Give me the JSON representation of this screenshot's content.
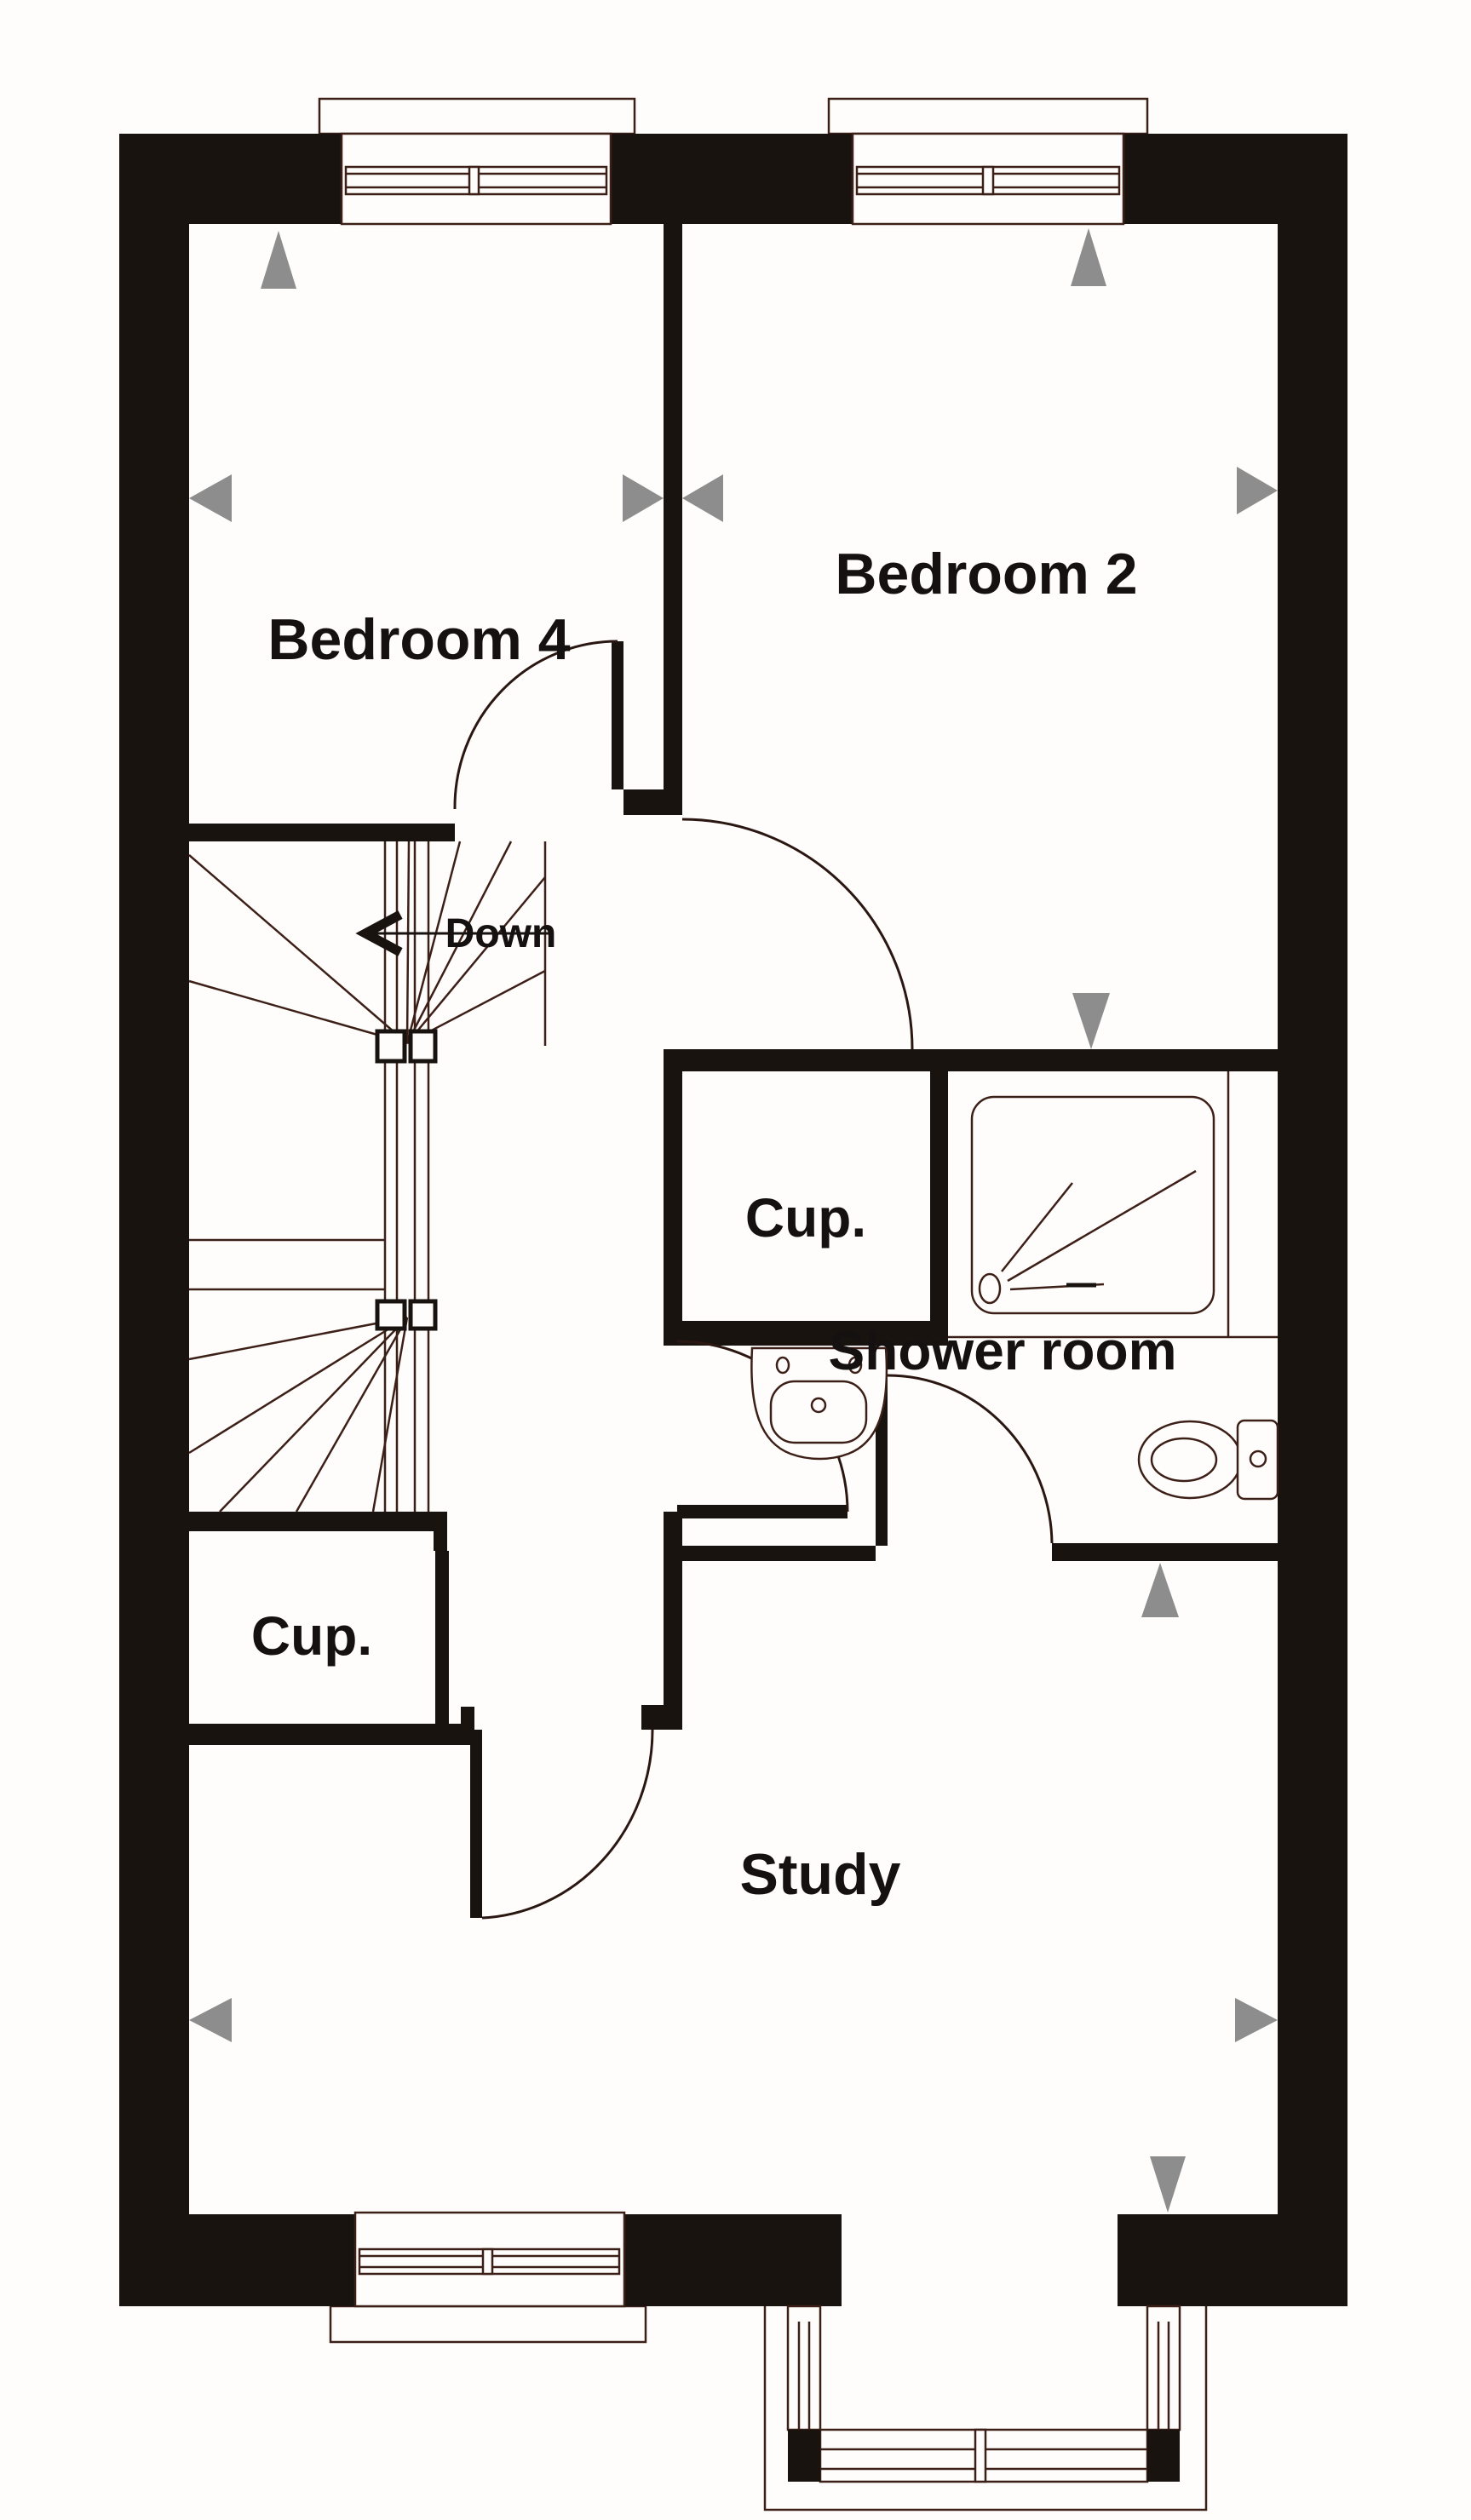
{
  "plan": {
    "labels": {
      "bedroom4": "Bedroom 4",
      "bedroom2": "Bedroom 2",
      "cupboard_middle": "Cup.",
      "shower_room": "Shower room",
      "cupboard_lower": "Cup.",
      "study": "Study",
      "stairs_direction": "Down"
    },
    "rooms": [
      {
        "name": "Bedroom 4"
      },
      {
        "name": "Bedroom 2"
      },
      {
        "name": "Shower room"
      },
      {
        "name": "Study"
      },
      {
        "name": "Cup."
      },
      {
        "name": "Cup."
      }
    ],
    "icons": {
      "direction_markers": "gray triangle markers pointing at walls and windows",
      "stairs": "winder staircase with Down arrow",
      "fixtures": [
        "shower-tray",
        "washbasin",
        "toilet"
      ]
    },
    "colors": {
      "wall": "#191310",
      "detail_line": "#3c2018",
      "marker_gray": "#8d8d8d",
      "background": "#fffdfc",
      "text": "#151110"
    }
  }
}
